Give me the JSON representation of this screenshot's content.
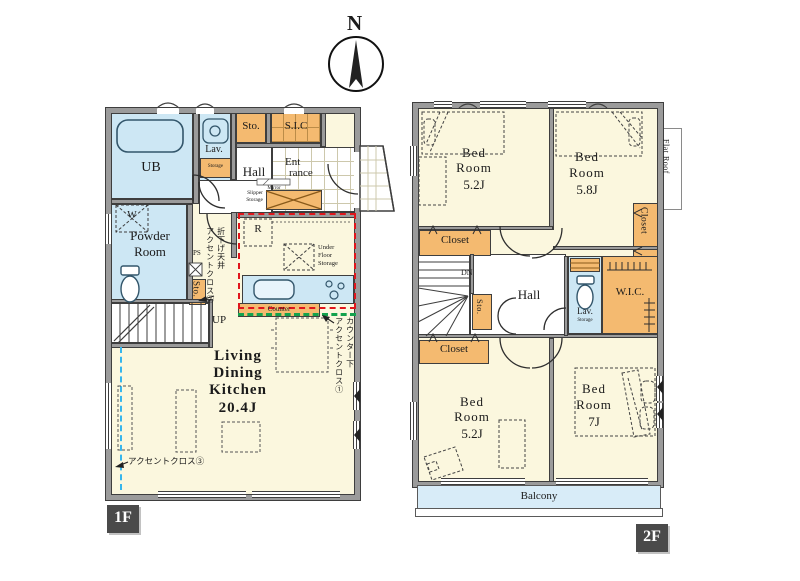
{
  "compass": {
    "north": "N"
  },
  "colors": {
    "wall": "#9b9b9b",
    "cream": "#fbf7de",
    "water": "#cde7f4",
    "storage": "#f4ba70",
    "balcony": "#d8ecf8",
    "accent_red": "#e0161c",
    "accent_green": "#13a24d",
    "accent_cyan": "#36b6ec",
    "badge_bg": "#4a4a4a"
  },
  "floor1": {
    "badge": "1F",
    "ub": "UB",
    "lav": "Lav.",
    "lav_storage": "Storage",
    "sto_top": "Sto.",
    "sic": "S.I.C",
    "hall": "Hall",
    "entrance": {
      "l1": "Ent",
      "l2": "rance"
    },
    "mirror": "Mirror",
    "slipper": {
      "l1": "Slipper",
      "l2": "Storage"
    },
    "powder": {
      "l1": "Powder",
      "l2": "Room"
    },
    "washer": "W",
    "ps": "PS",
    "sto_side": "Sto.",
    "fridge": "R",
    "under_floor": {
      "l1": "Under",
      "l2": "Floor",
      "l3": "Storage"
    },
    "counter": "Counter",
    "up": "UP",
    "ldk": {
      "l1": "Living",
      "l2": "Dining",
      "l3": "Kitchen",
      "size": "20.4J"
    },
    "accent1": {
      "col1": "カウンター下",
      "col2": "アクセントクロス①"
    },
    "accent2": {
      "col1": "折下げ天井",
      "col2": "アクセントクロス②"
    },
    "accent3": "アクセントクロス③"
  },
  "floor2": {
    "badge": "2F",
    "bedrooms": [
      {
        "l1": "Bed",
        "l2": "Room",
        "size": "5.2J"
      },
      {
        "l1": "Bed",
        "l2": "Room",
        "size": "5.8J"
      },
      {
        "l1": "Bed",
        "l2": "Room",
        "size": "5.2J"
      },
      {
        "l1": "Bed",
        "l2": "Room",
        "size": "7J"
      }
    ],
    "closet_left_top": "Closet",
    "closet_right": "Closet",
    "closet_left_bottom": "Closet",
    "flat_roof": "Flat Roof",
    "dn": "DN",
    "hall": "Hall",
    "sto": "Sto.",
    "lav": "Lav.",
    "lav_storage": "Storage",
    "wic": "W.I.C.",
    "balcony": "Balcony"
  }
}
